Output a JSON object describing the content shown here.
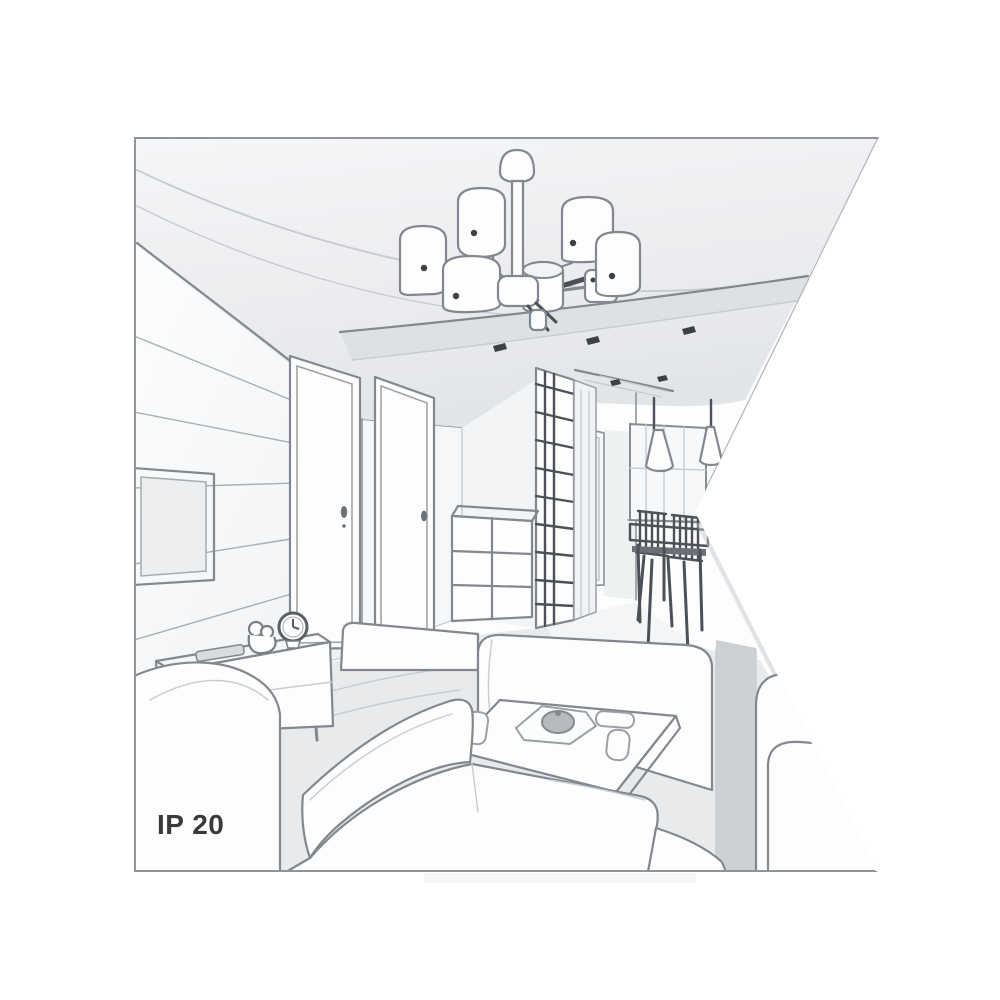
{
  "page": {
    "background": "#ffffff",
    "kind": "product-illustration"
  },
  "illustration": {
    "description": "Grayscale one-point-perspective line drawing of a living room interior; a triangular wedge is cut out of the right edge of the picture",
    "style": "pencil-sketch line art"
  },
  "labels": {
    "ip_rating": "IP 20"
  },
  "colors": {
    "ink": "#82888e",
    "ink_dark": "#4b5157",
    "ink_light": "#c7ccd1",
    "dark_accent": "#3c4146",
    "paper": "#ffffff",
    "ceiling": "#e7eaec",
    "soffit": "#dde1e4",
    "floor": "#e8eaec",
    "corridor_floor": "#f3f5f6",
    "side_shade": "#cdd1d4",
    "text": "#3a3a3c"
  },
  "scene": {
    "room": "living room with hallway and dining nook",
    "elements": [
      "six-shade ceiling chandelier",
      "recessed ceiling spotlights",
      "paneled TV wall with flat screen",
      "TV stand with remote, figurine and table clock",
      "two interior doors",
      "hallway door",
      "grid-front wardrobe",
      "grid-front drawer cabinet",
      "two cone pendant lamps",
      "dining table with chairs",
      "window",
      "corner sofa",
      "center sofa",
      "right sofa",
      "coffee table with tray, teapot and cups"
    ]
  }
}
